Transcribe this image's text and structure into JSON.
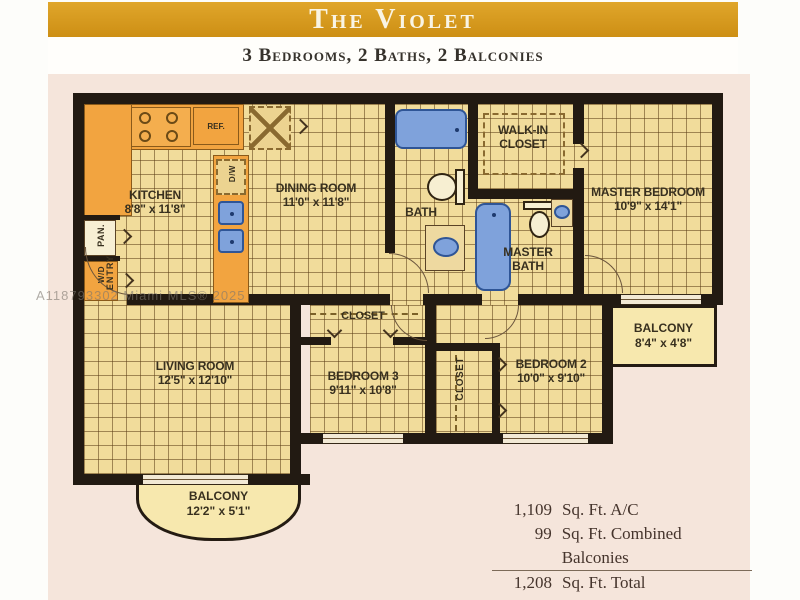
{
  "header": {
    "title": "The Violet",
    "subtitle": "3 Bedrooms, 2 Baths, 2 Balconies"
  },
  "watermark": "A118793302 Miami MLS® 2025",
  "rooms": {
    "kitchen": {
      "name": "KITCHEN",
      "dims": "8'8\" x 11'8\""
    },
    "dining": {
      "name": "DINING ROOM",
      "dims": "11'0\" x 11'8\""
    },
    "bath": {
      "name": "BATH"
    },
    "walkin_closet": {
      "line1": "WALK-IN",
      "line2": "CLOSET"
    },
    "master_bath": {
      "line1": "MASTER",
      "line2": "BATH"
    },
    "master_bedroom": {
      "name": "MASTER BEDROOM",
      "dims": "10'9\" x 14'1\""
    },
    "living": {
      "name": "LIVING ROOM",
      "dims": "12'5\" x 12'10\""
    },
    "bedroom3": {
      "name": "BEDROOM 3",
      "dims": "9'11\" x 10'8\""
    },
    "bedroom2": {
      "name": "BEDROOM 2",
      "dims": "10'0\" x 9'10\""
    },
    "balcony_bottom": {
      "name": "BALCONY",
      "dims": "12'2\" x 5'1\""
    },
    "balcony_right": {
      "name": "BALCONY",
      "dims": "8'4\" x 4'8\""
    },
    "closet_bed3": {
      "name": "CLOSET"
    },
    "closet_hall": {
      "name": "CLOSET"
    },
    "entry": {
      "name": "ENTRY"
    },
    "pantry": {
      "name": "PAN."
    },
    "washer_dryer": {
      "name": "W/D"
    },
    "dishwasher": {
      "name": "D/W"
    },
    "refrigerator": {
      "name": "REF."
    }
  },
  "stats": {
    "rows": [
      {
        "value": "1,109",
        "label": "Sq. Ft. A/C"
      },
      {
        "value": "99",
        "label": "Sq. Ft. Combined Balconies"
      },
      {
        "value": "1,208",
        "label": "Sq. Ft. Total"
      },
      {
        "value": "",
        "label": "Approximate"
      }
    ]
  },
  "colors": {
    "gold_band": "#d79a1f",
    "tile": "#f1dc9b",
    "wall": "#221a12",
    "fixture_blue": "#7fa2db",
    "counter_orange": "#f2a440",
    "balcony_fill": "#f7e8ae",
    "background_pink": "#f5e5db"
  }
}
